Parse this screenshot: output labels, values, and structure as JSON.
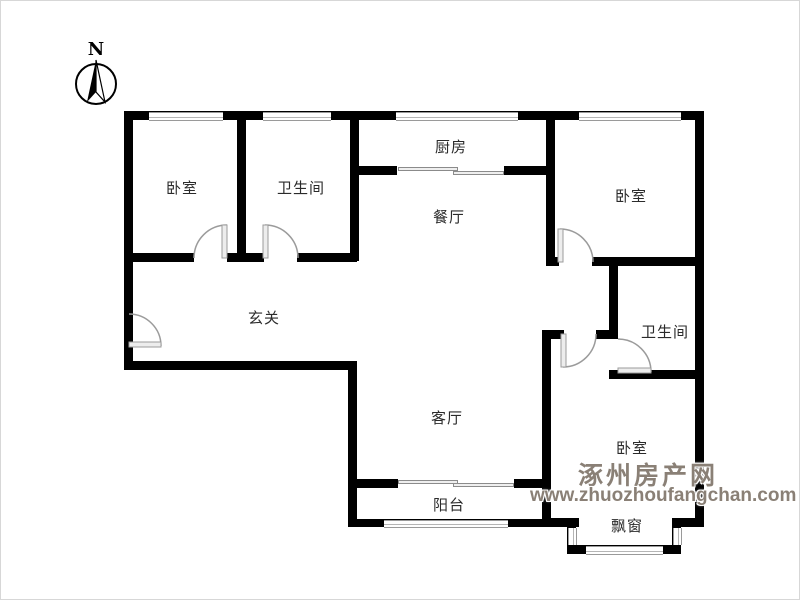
{
  "compass": {
    "north_label": "N"
  },
  "rooms": {
    "bedroom_top_left": {
      "label": "卧室"
    },
    "bathroom_top": {
      "label": "卫生间"
    },
    "kitchen": {
      "label": "厨房"
    },
    "dining_room": {
      "label": "餐厅"
    },
    "bedroom_top_right": {
      "label": "卧室"
    },
    "entry_hall": {
      "label": "玄关"
    },
    "bathroom_right": {
      "label": "卫生间"
    },
    "living_room": {
      "label": "客厅"
    },
    "bedroom_bottom_right": {
      "label": "卧室"
    },
    "balcony": {
      "label": "阳台"
    },
    "bay_window": {
      "label": "飘窗"
    }
  },
  "watermark": {
    "site_name": "涿州房产网",
    "site_url": "www.zhuozhoufangchan.com"
  },
  "colors": {
    "wall": "#000000",
    "door": "#999999",
    "window_line": "#9a9a9a",
    "label_text": "#2b2b2b",
    "watermark_text": "#8a8076"
  }
}
